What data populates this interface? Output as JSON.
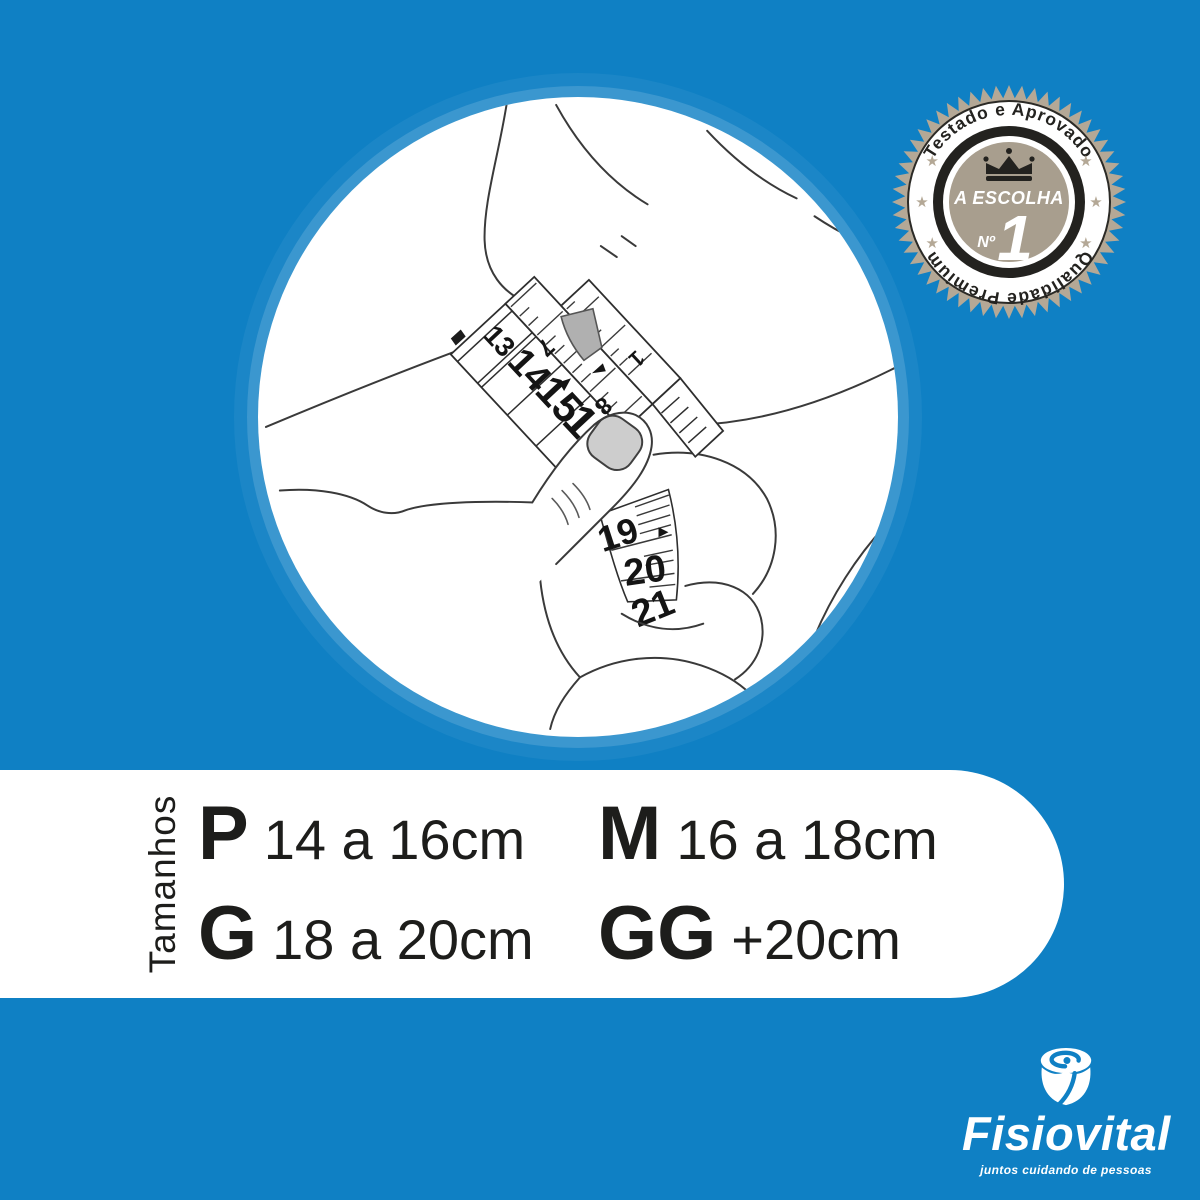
{
  "colors": {
    "background": "#0f80c4",
    "text": "#1d1d1b",
    "badge_tan": "#b4a896",
    "badge_inner_disc": "#a89e8e",
    "badge_ring_dark": "#23221f",
    "buckle_gray": "#b0b0b0",
    "nail_gray": "#cdcdcd",
    "white": "#ffffff"
  },
  "badge": {
    "arc_top": "Testado e Aprovado",
    "arc_bottom": "Qualidade Premium",
    "center_label": "A ESCOLHA",
    "ordinal": "Nº",
    "rank": "1"
  },
  "illustration": {
    "tape_main": [
      "13",
      "14",
      "15",
      "16"
    ],
    "tape_small": [
      "7",
      "8",
      "1"
    ],
    "tape_lower": [
      "19",
      "20",
      "21"
    ]
  },
  "size_panel": {
    "label": "Tamanhos",
    "sizes": [
      {
        "code": "P",
        "range": "14 a 16cm"
      },
      {
        "code": "M",
        "range": "16 a 18cm"
      },
      {
        "code": "G",
        "range": "18 a 20cm"
      },
      {
        "code": "GG",
        "range": "+20cm"
      }
    ]
  },
  "logo": {
    "name": "Fisiovital",
    "tagline": "juntos cuidando de pessoas"
  }
}
